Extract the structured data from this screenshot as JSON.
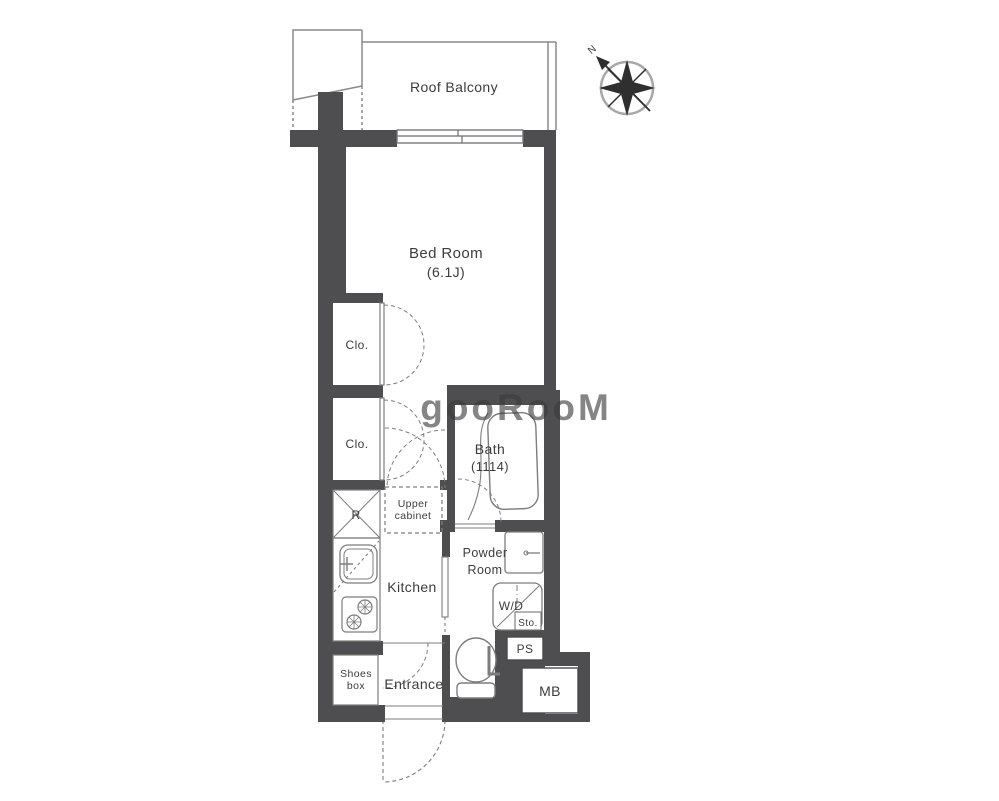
{
  "plan": {
    "balcony": {
      "label": "Roof Balcony"
    },
    "bedroom": {
      "label": "Bed Room",
      "size": "(6.1J)"
    },
    "closet1": {
      "label": "Clo."
    },
    "closet2": {
      "label": "Clo."
    },
    "bath": {
      "label": "Bath",
      "size": "(1114)"
    },
    "refrigerator": {
      "label": "R"
    },
    "upper_cabinet": {
      "line1": "Upper",
      "line2": "cabinet"
    },
    "kitchen": {
      "label": "Kitchen"
    },
    "powder_room": {
      "line1": "Powder",
      "line2": "Room"
    },
    "washer_dryer": {
      "label": "W/D",
      "storage_label": "Sto."
    },
    "pipe_space": {
      "label": "PS"
    },
    "shoes_box": {
      "line1": "Shoes",
      "line2": "box"
    },
    "entrance": {
      "label": "Entrance"
    },
    "meter_box": {
      "label": "MB"
    },
    "compass": {
      "north_label": "N"
    },
    "watermark": {
      "text": "gooRooM"
    }
  },
  "colors": {
    "wall": "#4e4e50",
    "thin_line": "#7d7d7d",
    "text": "#3c3c3c",
    "watermark": "#c8c8c8"
  }
}
